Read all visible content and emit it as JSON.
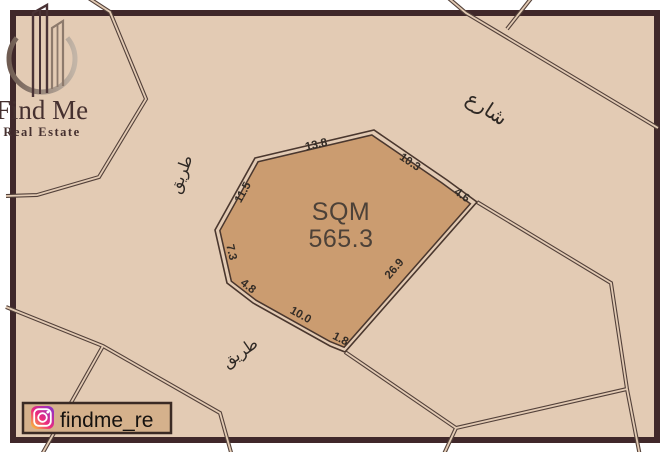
{
  "brand": {
    "name": "Find Me",
    "tagline": "Real Estate"
  },
  "social": {
    "platform": "instagram",
    "handle": "findme_re"
  },
  "plot": {
    "area_label": "SQM",
    "area_value": "565.3",
    "dimensions": [
      "13.8",
      "10.3",
      "4.6",
      "26.9",
      "1.8",
      "10.0",
      "4.8",
      "7.3",
      "11.5"
    ]
  },
  "map": {
    "labels": [
      {
        "text": "شارع",
        "meaning": "street"
      },
      {
        "text": "طريق",
        "meaning": "road"
      },
      {
        "text": "طريق",
        "meaning": "road"
      }
    ]
  },
  "colors": {
    "map_background": "#e3cbb4",
    "plot_fill": "#cb9c70",
    "road_line": "#53413a",
    "frame": "#40282a",
    "badge_fill": "#d5b18c"
  }
}
